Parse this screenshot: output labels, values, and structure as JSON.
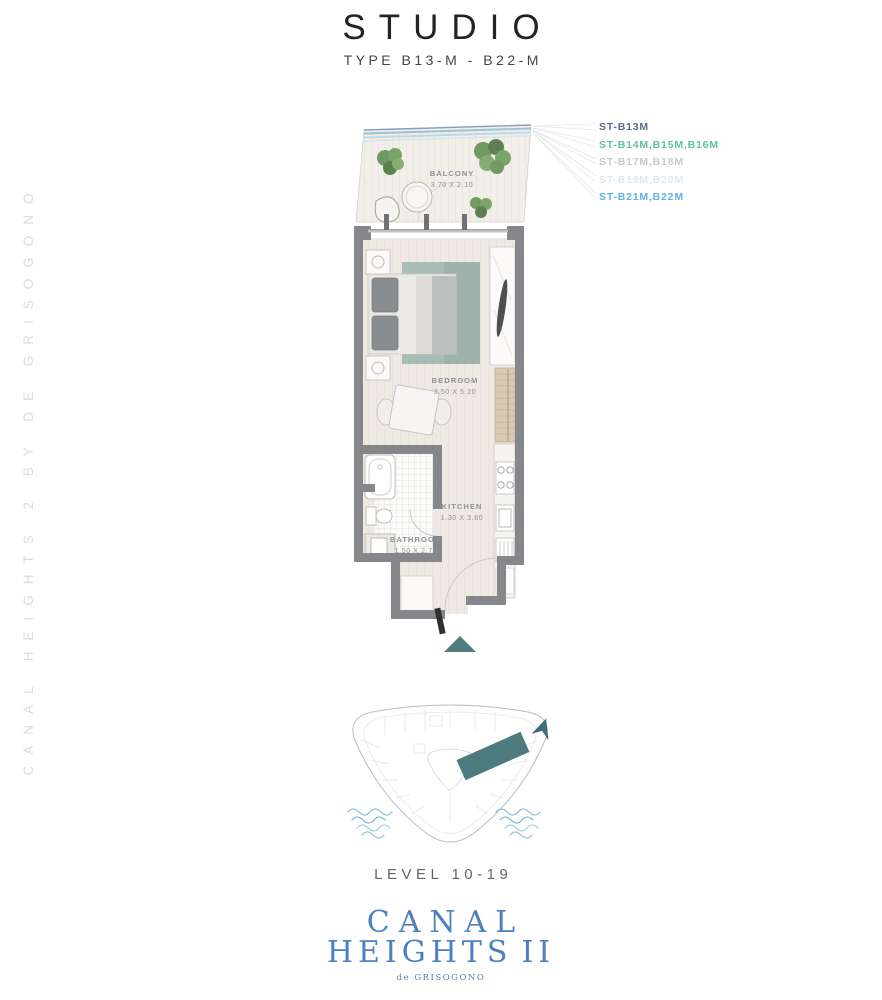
{
  "page": {
    "title": "STUDIO",
    "subtitle": "TYPE B13-M - B22-M"
  },
  "watermark": {
    "text": "CANAL HEIGHTS 2 BY DE GRISOGONO"
  },
  "legend": {
    "items": [
      {
        "label": "ST-B13M",
        "color": "#5c6b8c"
      },
      {
        "label": "ST-B14M,B15M,B16M",
        "color": "#5fc0a4"
      },
      {
        "label": "ST-B17M,B18M",
        "color": "#c6cacd"
      },
      {
        "label": "ST-B19M,B20M",
        "color": "#dce9f2"
      },
      {
        "label": "ST-B21M,B22M",
        "color": "#5fb4e6"
      }
    ]
  },
  "floorplan": {
    "rooms": {
      "balcony": {
        "name": "BALCONY",
        "dims": "3.70 X 2.10"
      },
      "bedroom": {
        "name": "BEDROOM",
        "dims": "3.50 X 5.20"
      },
      "kitchen": {
        "name": "KITCHEN",
        "dims": "1.30 X 3.80"
      },
      "bathroom": {
        "name": "BATHROOM",
        "dims": "1.50 X 2.70"
      }
    }
  },
  "level": {
    "label": "LEVEL 10-19"
  },
  "brand": {
    "name_line1": "CANAL",
    "name_line2": "HEIGHTS",
    "numeral": "II",
    "tagline": "de GRISOGONO"
  },
  "colors": {
    "wall": "#85878a",
    "floor": "#efe9e3",
    "accent_teal": "#4f7d80",
    "water": "#7fbcd9",
    "brand_blue": "#4d80c0"
  }
}
